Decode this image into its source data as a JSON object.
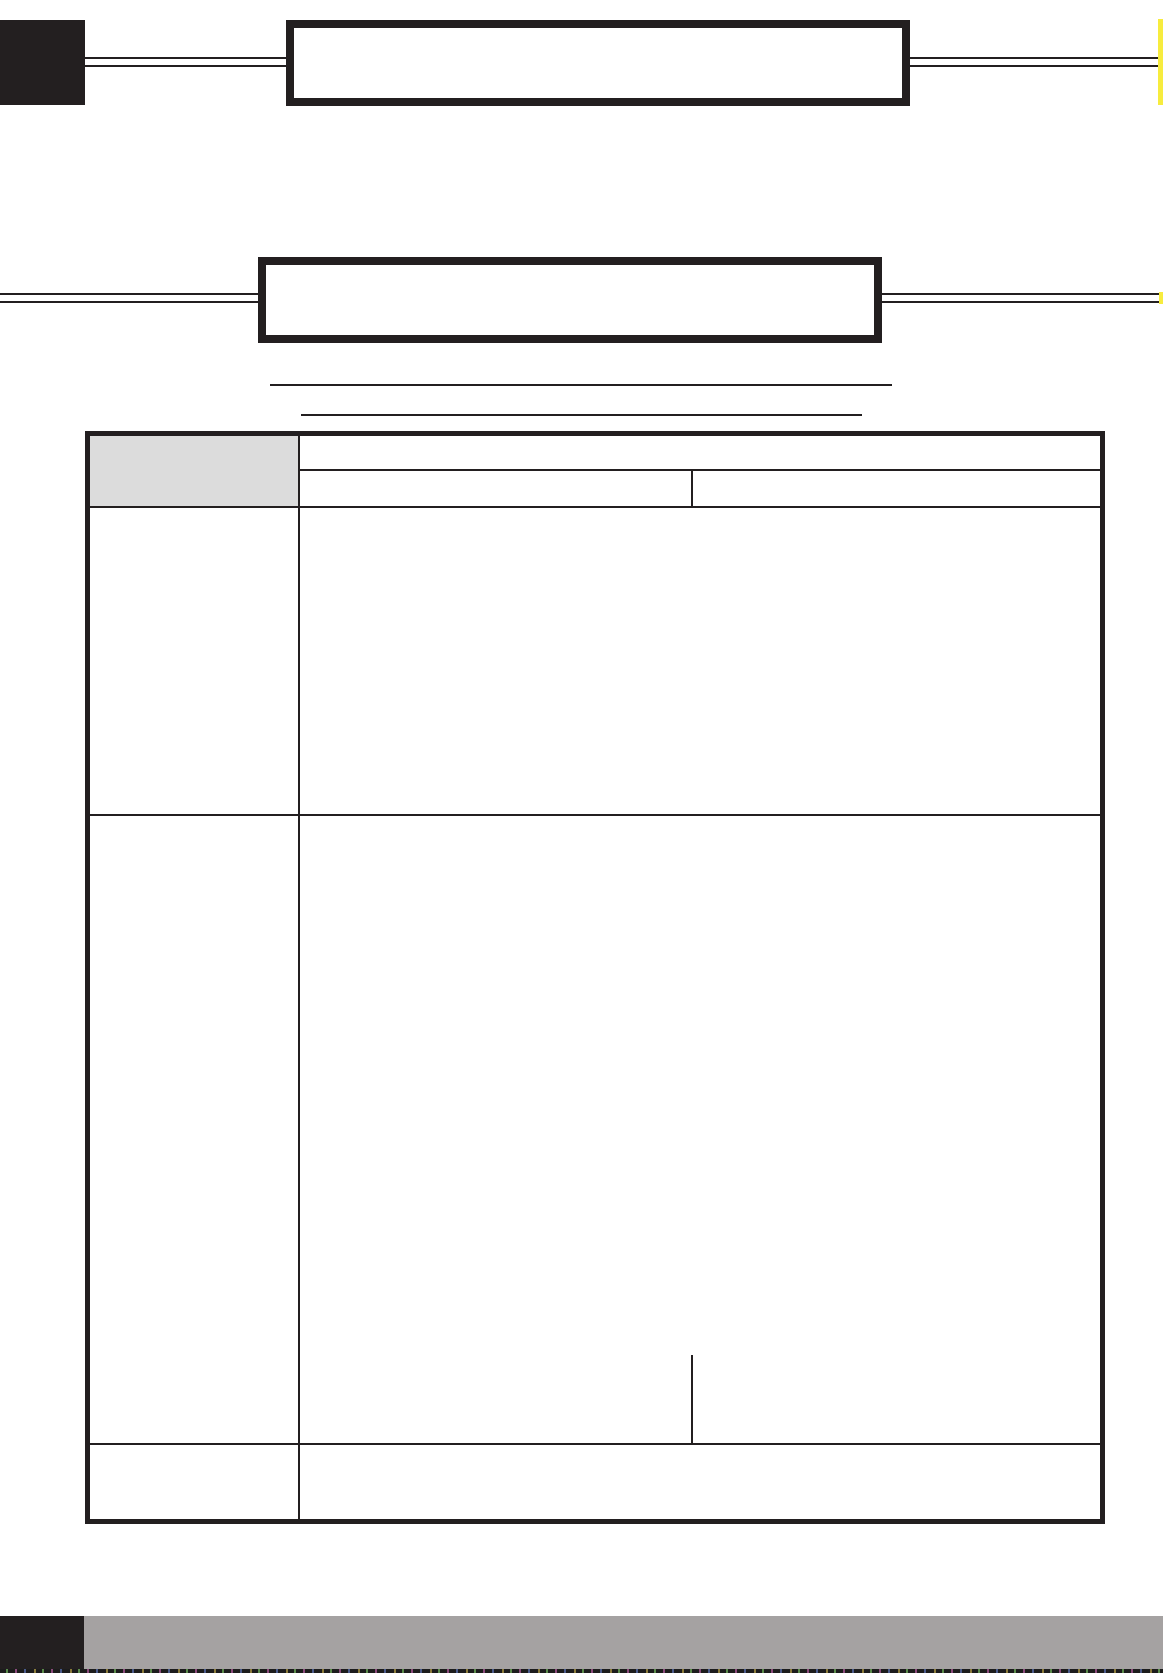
{
  "page": {
    "background": "#ffffff",
    "ink": "#231f20",
    "accent_yellow": "#f7ec3e",
    "header_cell_gray": "#dcdcdc",
    "footer_band_gray": "#a5a2a2"
  },
  "header": {
    "title_box_1": {
      "text": ""
    },
    "title_box_2": {
      "text": ""
    },
    "write_line_1": {
      "text": ""
    },
    "write_line_2": {
      "text": ""
    }
  },
  "table": {
    "corner_header": {
      "text": ""
    },
    "header_top": {
      "text": ""
    },
    "header_left": {
      "text": ""
    },
    "header_right": {
      "text": ""
    },
    "rows": [
      {
        "label": "",
        "content": ""
      },
      {
        "label": "",
        "content": ""
      },
      {
        "label": "",
        "content": ""
      }
    ]
  },
  "footer": {
    "band_text": ""
  }
}
